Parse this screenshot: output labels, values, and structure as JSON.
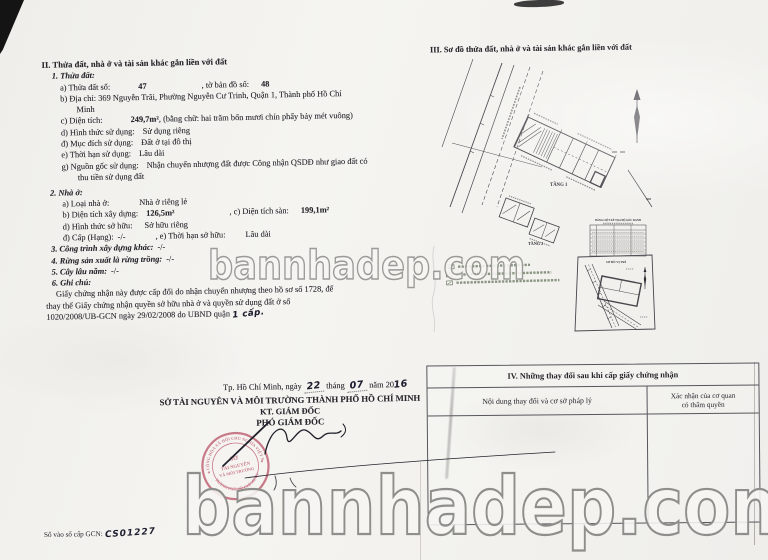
{
  "watermark": {
    "text": "bannhadep.com"
  },
  "sec2": {
    "title": "II. Thửa đất, nhà ở và tài sản khác gắn liền với đất",
    "land": {
      "heading": "1. Thửa đất:",
      "a_label": "a) Thửa đất số:",
      "a_value": "47",
      "a_label2": ", tờ bản đồ số:",
      "a_value2": "48",
      "b_line1": "b) Địa chỉ: 369 Nguyễn Trãi, Phường Nguyễn Cư Trinh, Quận 1, Thành phố Hồ Chí",
      "b_line2": "Minh",
      "c_label": "c) Diện tích:",
      "c_value": "249,7m²",
      "c_rest": ", (bằng chữ: hai trăm bốn mươi chín phẩy bảy mét vuông)",
      "d_label": "d) Hình thức sử dụng:",
      "d_value": "Sử dụng riêng",
      "dd_label": "đ) Mục đích sử dụng:",
      "dd_value": "Đất ở tại đô thị",
      "e_label": "e) Thời hạn sử dụng:",
      "e_value": "Lâu dài",
      "g_label": "g) Nguồn gốc sử dụng:",
      "g_value": "Nhận chuyển nhượng đất được Công nhận QSDĐ như giao đất có",
      "g_line2": "thu tiền sử dụng đất"
    },
    "house": {
      "heading": "2. Nhà ở:",
      "a_label": "a) Loại nhà ở:",
      "a_value": "Nhà ở riêng lẻ",
      "b_label": "b) Diện tích xây dựng:",
      "b_value": "126,5m²",
      "c_label": ", c) Diện tích sàn:",
      "c_value": "199,1m²",
      "d_label": "d) Hình thức sở hữu:",
      "d_value": "Sở hữu riêng",
      "dd_label": "đ) Cấp (Hạng):",
      "dd_value": "-/-",
      "e_label": ", e) Thời hạn sở hữu:",
      "e_value": "Lâu dài"
    },
    "item3_label": "3. Công trình xây dựng khác:",
    "item3_value": "-/-",
    "item4_label": "4. Rừng sản xuất là rừng trồng:",
    "item4_value": "-/-",
    "item5_label": "5. Cây lâu năm:",
    "item5_value": "-/-",
    "item6_label": "6. Ghi chú:",
    "note1": "Giấy chứng nhận này được cấp đổi do nhận chuyển nhượng theo hồ sơ số 1728, để",
    "note2": "thay thế Giấy chứng nhận quyền sở hữu nhà ở và quyền sử dụng đất ở số",
    "note3a": "1020/2008/UB-GCN ngày 29/02/2008 do UBND quận",
    "note3b": "1 cấp."
  },
  "sec3": {
    "title": "III. Sơ đồ thửa đất, nhà ở và tài sản khác gắn liền với đất",
    "floor1_label": "TẦNG 1",
    "floor2_label": "TẦNG 2",
    "coord_table_title": "BẢNG LIỆT KÊ TỌA ĐỘ GÓC RANH",
    "location_label": "SƠ ĐỒ VỊ TRÍ"
  },
  "sec4": {
    "title": "IV. Những thay đổi sau khi cấp giấy chứng nhận",
    "col1": "Nội dung thay đổi và cơ sở pháp lý",
    "col2_line1": "Xác nhận của cơ quan",
    "col2_line2": "có thẩm quyền"
  },
  "signature": {
    "date_prefix": "Tp. Hồ Chí Minh, ngày",
    "date_day": "22",
    "date_month_label": "tháng",
    "date_month": "07",
    "date_year_label": "năm 20",
    "date_year": "16",
    "org": "SỞ TÀI NGUYÊN VÀ MÔI TRƯỜNG THÀNH PHỐ HỒ CHÍ MINH",
    "kt": "KT. GIÁM ĐỐC",
    "deputy": "PHÓ GIÁM ĐỐC",
    "stamp": {
      "top_arc": "CỘNG HÒA XÃ HỘI CHỦ NGHĨA VIỆT NAM",
      "center1": "SỞ",
      "center2": "TÀI NGUYÊN",
      "center3": "VÀ MÔI TRƯỜNG",
      "bottom_arc": "THÀNH PHỐ HỒ CHÍ MINH"
    }
  },
  "footer": {
    "gcn_label": "Số vào sổ cấp GCN:",
    "gcn_value": "CS01227"
  }
}
